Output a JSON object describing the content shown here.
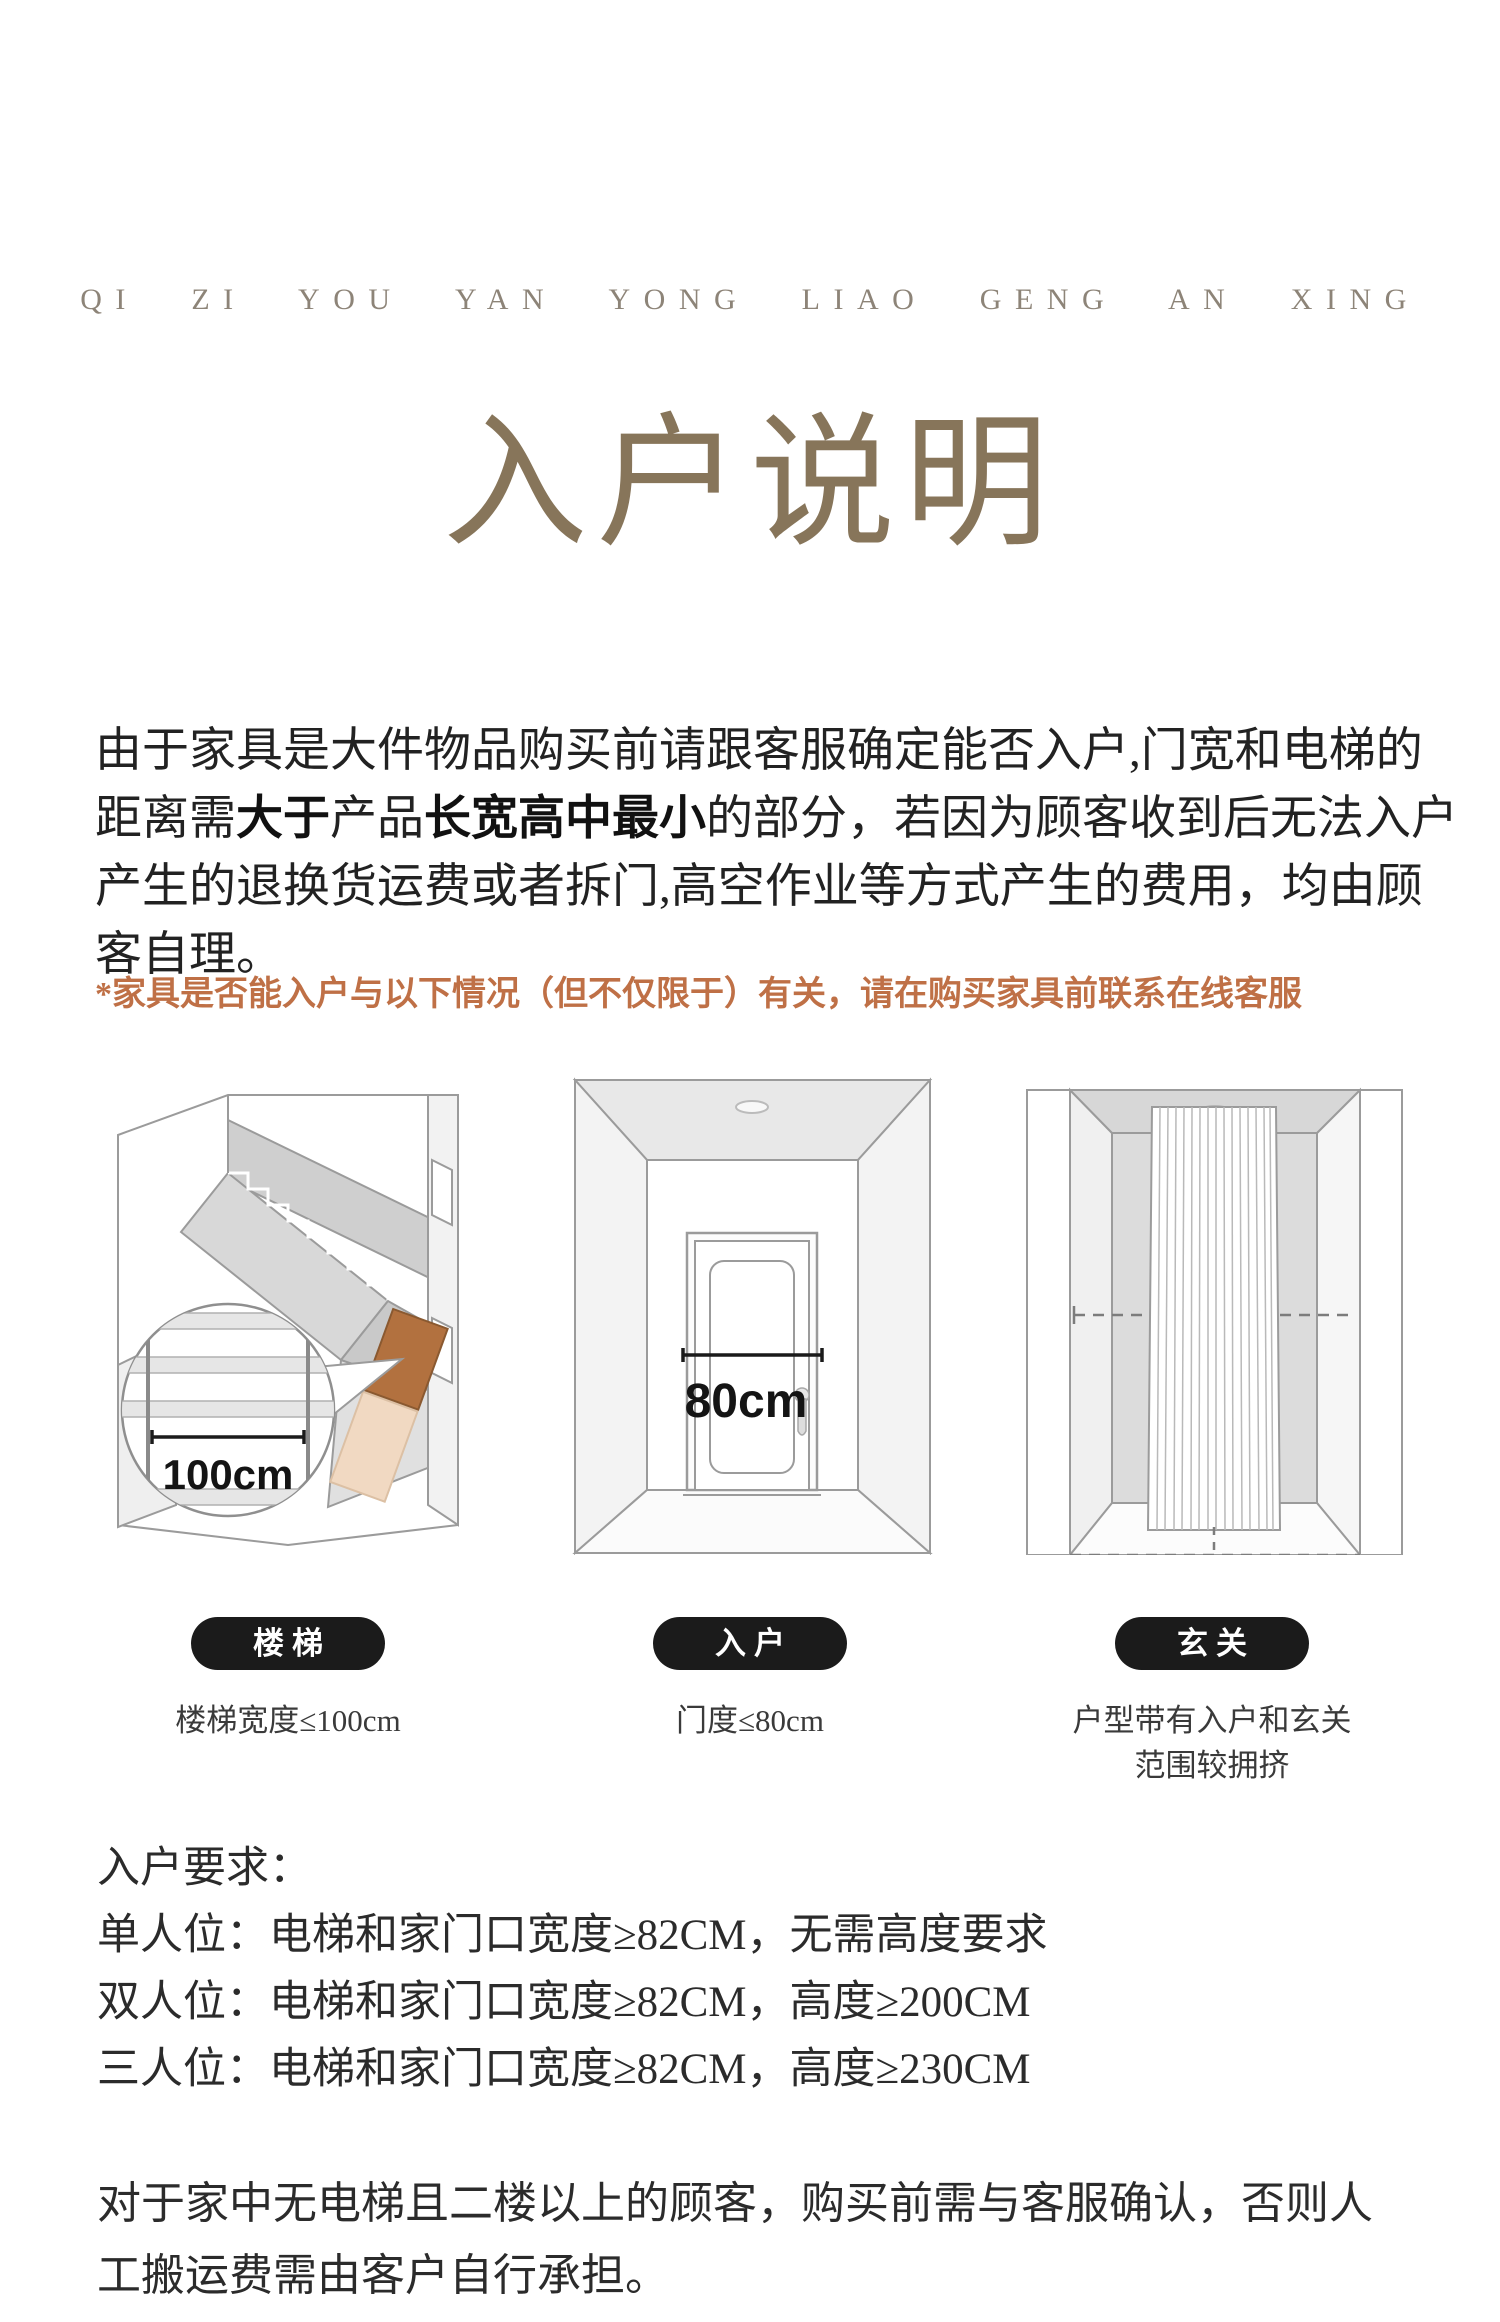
{
  "brand_eyebrow": "QI ZI YOU YAN YONG LIAO GENG AN XING",
  "title": "入户说明",
  "intro": {
    "s1": "由于家具是大件物品购买前请跟客服确定能否入户,门宽和电梯的距离需",
    "s2": "大于",
    "s3": "产品",
    "s4": "长宽高中最小",
    "s5": "的部分，若因为顾客收到后无法入户产生的退换货运费或者拆门,高空作业等方式产生的费用，均由顾客自理。"
  },
  "note": "*家具是否能入户与以下情况（但不仅限于）有关，请在购买家具前联系在线客服",
  "figures": [
    {
      "badge": "楼梯",
      "caption": "楼梯宽度≤100cm",
      "measure": "100cm"
    },
    {
      "badge": "入户",
      "caption": "门度≤80cm",
      "measure": "80cm"
    },
    {
      "badge": "玄关",
      "caption": "户型带有入户和玄关",
      "caption2": "范围较拥挤"
    }
  ],
  "requirements": {
    "title": "入户要求：",
    "items": [
      "单人位：电梯和家门口宽度≥82CM，无需高度要求",
      "双人位：电梯和家门口宽度≥82CM，高度≥200CM",
      "三人位：电梯和家门口宽度≥82CM，高度≥230CM"
    ]
  },
  "delivery_note": "对于家中无电梯且二楼以上的顾客，购买前需与客服确认，否则人工搬运费需由客户自行承担。",
  "colors": {
    "accent_orange": "#bf7046",
    "title_taupe": "#87755a",
    "badge_black": "#1b1b1b",
    "box_brown": "#b2713f"
  }
}
